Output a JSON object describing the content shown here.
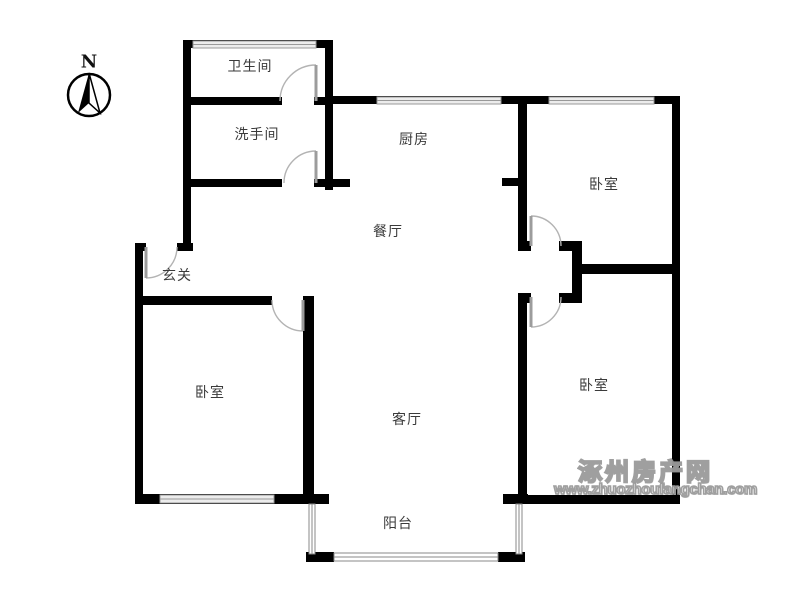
{
  "compass": {
    "label": "N"
  },
  "rooms": {
    "bathroom": "卫生间",
    "washroom": "洗手间",
    "kitchen": "厨房",
    "bedroom_ne": "卧室",
    "dining": "餐厅",
    "entrance": "玄关",
    "bedroom_w": "卧室",
    "living": "客厅",
    "bedroom_se": "卧室",
    "balcony": "阳台"
  },
  "watermark": {
    "site_name": "涿州房产网",
    "site_url": "www.zhuozhoufangchan.com"
  },
  "colors": {
    "wall": "#000000",
    "door_arc": "#b3b3b3",
    "door_leaf": "#9c9c9c",
    "window_fill": "#ececec",
    "window_stroke": "#999999",
    "label_text": "#3a3a3a",
    "watermark": "#9a9a9a"
  }
}
